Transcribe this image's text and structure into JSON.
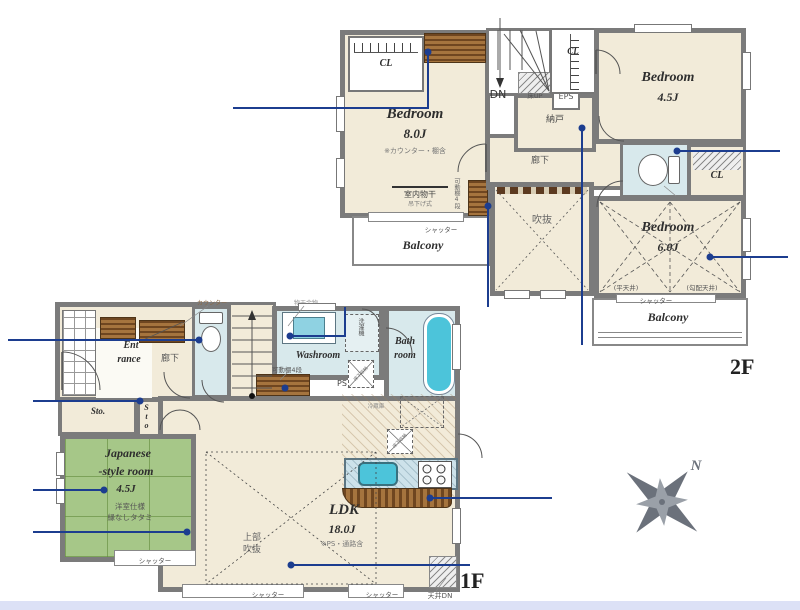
{
  "shared": {
    "cl": "CL",
    "shutter": "シャッター",
    "balcony": "Balcony",
    "bedroom": "Bedroom",
    "sto": "Sto.",
    "hallway": "廊下",
    "kadou_dana": "可動棚4段",
    "yukashita": "床下収納",
    "counter_label": "カウンター"
  },
  "f2": {
    "floor_label": "2F",
    "bedroom8_size": "8.0J",
    "bedroom8_note": "※カウンター・棚含",
    "monohoshi": "室内物干",
    "monohoshi_sub": "吊下げ式",
    "dn": "DN",
    "yuka_up": "床UP",
    "eps": "EPS",
    "nando": "納戸",
    "bedroom45_size": "4.5J",
    "counter": "カウンタ",
    "bedroom6_size": "6.0J",
    "flat_ceiling": "(平天井)",
    "sloped_ceiling": "(勾配天井)",
    "void": "吹抜"
  },
  "f1": {
    "floor_label": "1F",
    "entrance_l1": "Ent",
    "entrance_l2": "rance",
    "up": "UP",
    "jp_l1": "Japanese",
    "jp_l2": "-style room",
    "jp_size": "4.5J",
    "jp_note1": "洋室仕様",
    "jp_note2": "縁なしタタミ",
    "washroom": "Washroom",
    "washer": "洗濯機",
    "ps": "PS",
    "bath_l1": "Bath",
    "bath_l2": "room",
    "niche": "造作ニッチ",
    "monohoshi_hw": "物干金物",
    "ldk": "LDK",
    "ldk_size": "18.0J",
    "ldk_note": "※PS・通路含",
    "void_l1": "上部",
    "void_l2": "吹抜",
    "fridge": "冷蔵庫",
    "ceiling_dn": "天井DN"
  },
  "compass": {
    "north": "N"
  },
  "colors": {
    "wall": "#7b7b7b",
    "floor": "#f2ebd9",
    "tatami": "#a6c788",
    "water_area": "#d8e9ec",
    "bathtub": "#4cc4da",
    "annotation_blue": "#1c3d8f",
    "wood_shelf": "#a5743e",
    "bottom_strip": "#dce1f6",
    "compass_gray": "#6b717b"
  }
}
